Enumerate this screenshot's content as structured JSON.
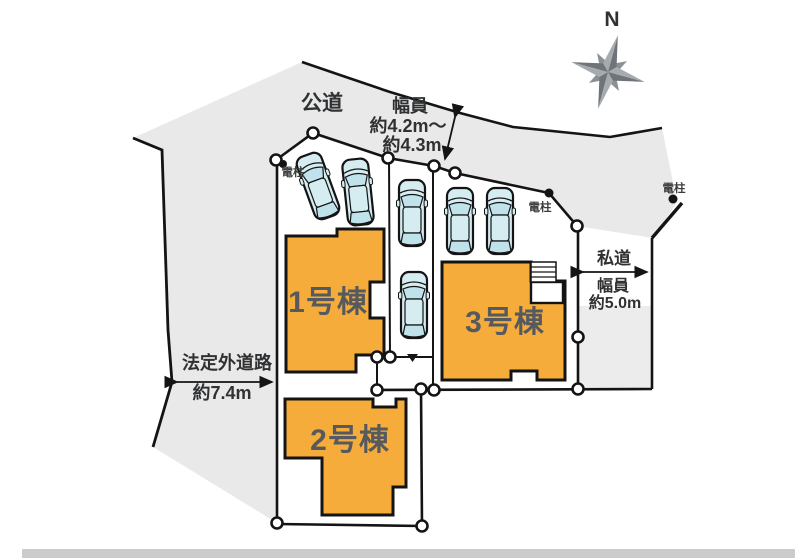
{
  "site_plan": {
    "compass": {
      "north": "N"
    },
    "labels": {
      "public_road": "公道",
      "public_road_width_title": "幅員",
      "public_road_width_line1": "約4.2m〜",
      "public_road_width_line2": "約4.3m",
      "private_road_name": "私道",
      "private_road_width_title": "幅員",
      "private_road_width_value": "約5.0m",
      "unofficial_road_name": "法定外道路",
      "unofficial_road_width_value": "約7.4m",
      "utility_pole_1": "電柱",
      "utility_pole_2": "電柱",
      "utility_pole_3": "電柱"
    },
    "buildings": [
      {
        "name": "1号棟"
      },
      {
        "name": "2号棟"
      },
      {
        "name": "3号棟"
      }
    ],
    "colors": {
      "building_fill": "#F6AC3A",
      "car_fill": "#D5ECF1",
      "car_window": "#C0E2EB",
      "area_gray": "#E9E9E9",
      "neighbor_gray": "#ECECEC",
      "outline": "#141414",
      "label_gray": "#565A5E",
      "bottom_bar": "#CBCBCB",
      "compass_gray": "#8B9095"
    }
  }
}
